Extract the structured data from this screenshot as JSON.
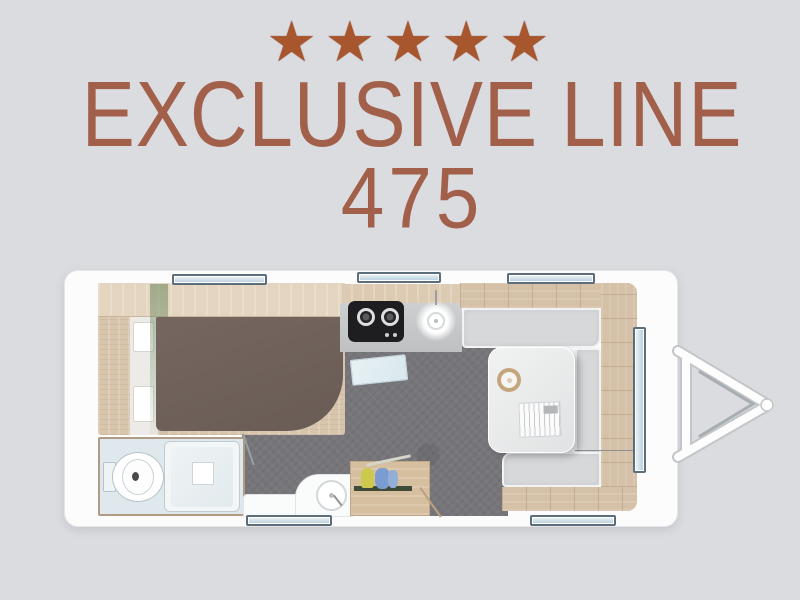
{
  "page": {
    "background": "#dbdce0"
  },
  "header": {
    "stars": "★★★★★",
    "star_count": 5,
    "star_color": "#a8562e",
    "title": "EXCLUSIVE LINE",
    "model": "475",
    "text_color": "#a2604a"
  },
  "floorplan": {
    "type": "caravan-top-view",
    "colors": {
      "shell": "#fcfcfd",
      "floor": "#76757a",
      "wood": "#d8c5ad",
      "mattress": "#6e6159",
      "cushion": "#d6d8da",
      "bathroom": "#dfe9ed",
      "window_fill": "#b6cddb",
      "window_border": "#5c6e7b",
      "stove": "#1e1e20"
    },
    "features": [
      "french-bed",
      "wardrobe-shelf",
      "bathroom",
      "toilet",
      "shower",
      "kitchen-counter",
      "two-burner-stove",
      "kitchen-sink",
      "washbasin",
      "open-cabinet",
      "u-shaped-dinette",
      "dinette-table",
      "bowl",
      "magazine",
      "five-windows",
      "drawbar-hitch"
    ],
    "window_count": 6
  }
}
